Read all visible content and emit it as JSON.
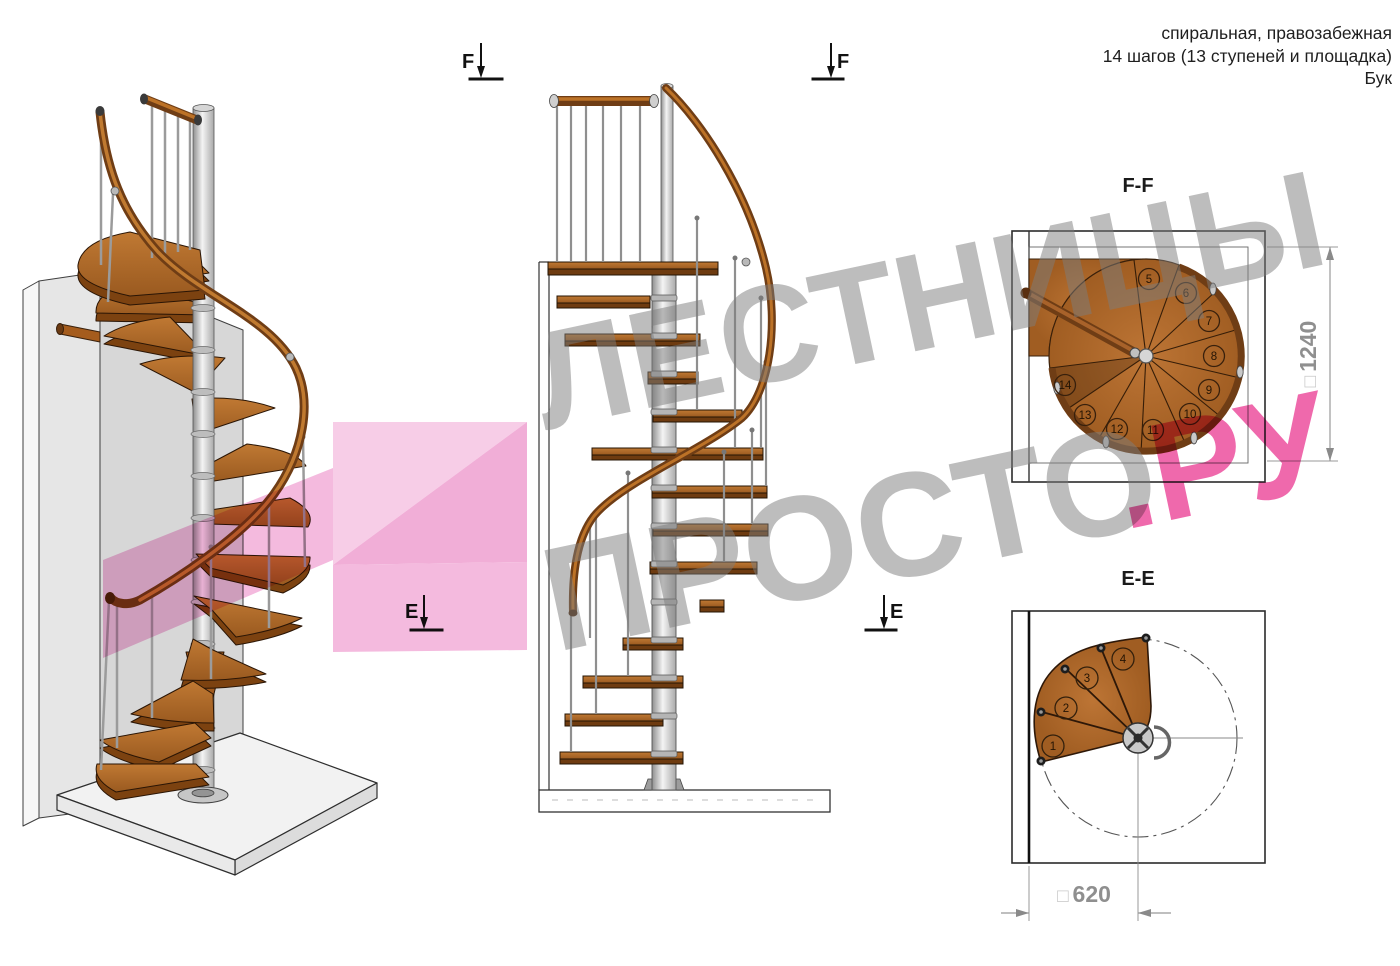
{
  "header": {
    "line1": "спиральная, правозабежная",
    "line2": "14 шагов (13 ступеней и площадка)",
    "line3": "Бук"
  },
  "markers": {
    "f_label": "F",
    "e_label": "E"
  },
  "views": {
    "ff": {
      "title": "F-F",
      "dim_prefix": "□",
      "dim_value": "1240",
      "steps": [
        "5",
        "6",
        "7",
        "8",
        "9",
        "10",
        "11",
        "12",
        "13",
        "14"
      ]
    },
    "ee": {
      "title": "E-E",
      "dim_prefix": "□",
      "dim_value": "620",
      "steps": [
        "1",
        "2",
        "3",
        "4"
      ]
    }
  },
  "watermark": {
    "word1": "ЛЕСТНИЦЫ",
    "word2": "ПРОСТО",
    "word3": ".РУ"
  },
  "colors": {
    "wood": "#b26b2b",
    "wood_dark": "#6e3b10",
    "rail": "#6f3d15",
    "rail_light": "#bc7227",
    "pole": "#d9d9d9",
    "pink": "#ec4f9e",
    "watermark_gray": "#7d7d7d",
    "dim_gray": "#8f8f8f"
  }
}
